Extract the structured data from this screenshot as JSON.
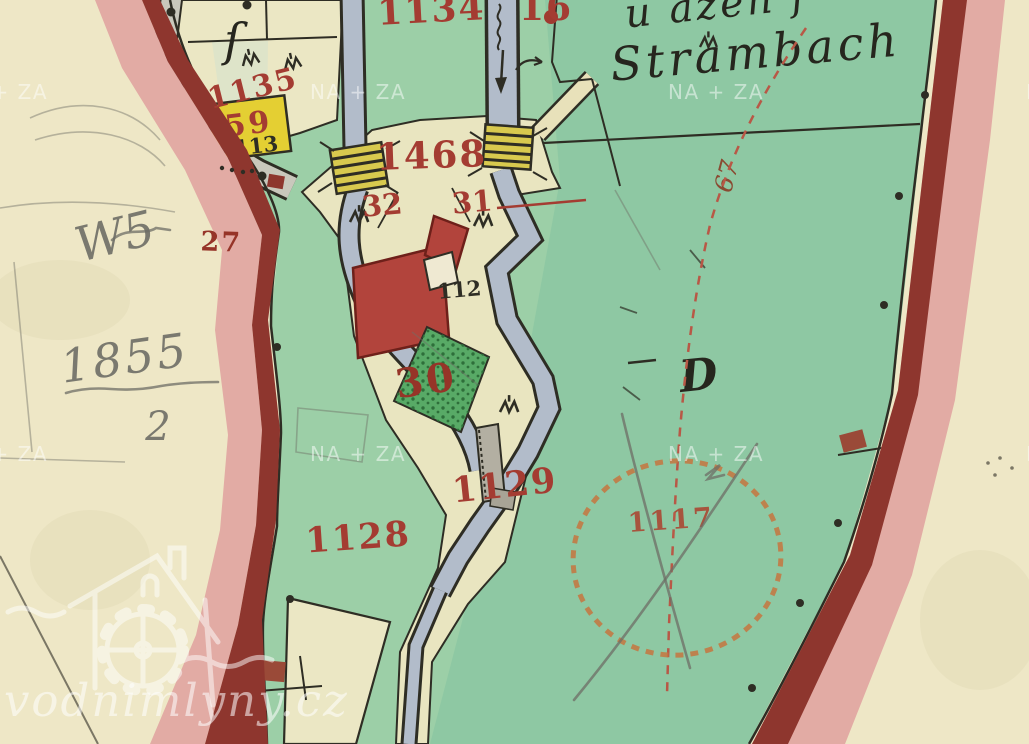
{
  "map_type": "historical cadastral map scan",
  "labels": {
    "n1134": "1134",
    "n16": "16",
    "n1468": "1468",
    "n1135": "1135",
    "n59": "59",
    "n113": "113",
    "n32": "32",
    "n31": "31",
    "n112": "112",
    "n30": "30",
    "n1129": "1129",
    "n1128": "1128",
    "n27": "27",
    "n1117": "1117",
    "n67": "67",
    "letter_d": "D",
    "letter_f": "ſ"
  },
  "script": {
    "line1": "u ažen f",
    "line2": "Strambach"
  },
  "pencil": {
    "note": "W5",
    "year": "1855",
    "denominator": "2"
  },
  "watermark": {
    "tile": "NA + ZA",
    "site": "vodnimlyny.cz"
  },
  "palette": {
    "paper": "#eee7c6",
    "green": "#9ccfa7",
    "green_tint": "rgba(96,176,150,0.22)",
    "parcel_cream": "#ebe7c4",
    "parcel_pale": "#dee4c9",
    "corridor": "#e9e5c0",
    "road_gray": "#c9c8bc",
    "stream": "#b2bcca",
    "dark_red": "#8e362e",
    "pink": "#e2aba4",
    "pink_light": "#ecc4bd",
    "label_red": "#a43c32",
    "label_red2": "#963428",
    "yellow": "#e4cf33",
    "bridge_yellow": "#d8c94e",
    "building_red": "#b2443c",
    "building_border": "#6e201a",
    "garden_green": "#58aa66",
    "garden_dot": "#2e6f3a",
    "ink": "#2e2d24",
    "pencil": "#6e6e66",
    "orange": "#c5763f",
    "dash_red": "#b85846",
    "brown_marker": "#9a4a38"
  }
}
